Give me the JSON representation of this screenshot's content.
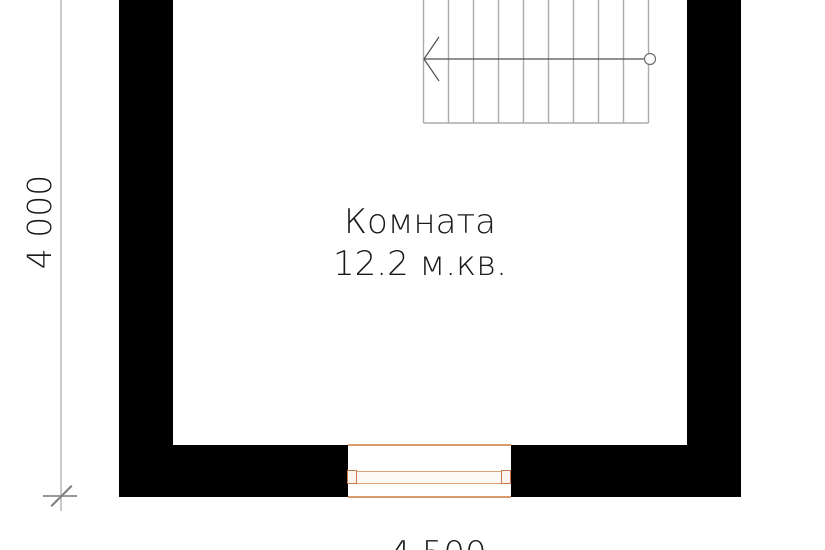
{
  "drawing": {
    "type": "floor-plan",
    "room_label": {
      "name": "Комната",
      "area": "12.2 м.кв."
    },
    "dimensions": {
      "left_vertical": "4 000",
      "bottom_horizontal": "4 500"
    },
    "staircase": {
      "treads": 9,
      "direction_arrow": "left",
      "start_marker": "circle"
    },
    "colors": {
      "walls": "#000000",
      "stair_lines": "#ababab",
      "stair_arrow": "#4f4f4f",
      "dimension_line": "#c9c9c9",
      "dimension_tick": "#8a8a8a",
      "window_lines": "#d99a6c",
      "window_frame": "#c9784a",
      "label_text": "#1a1a1a",
      "background": "#ffffff"
    }
  }
}
